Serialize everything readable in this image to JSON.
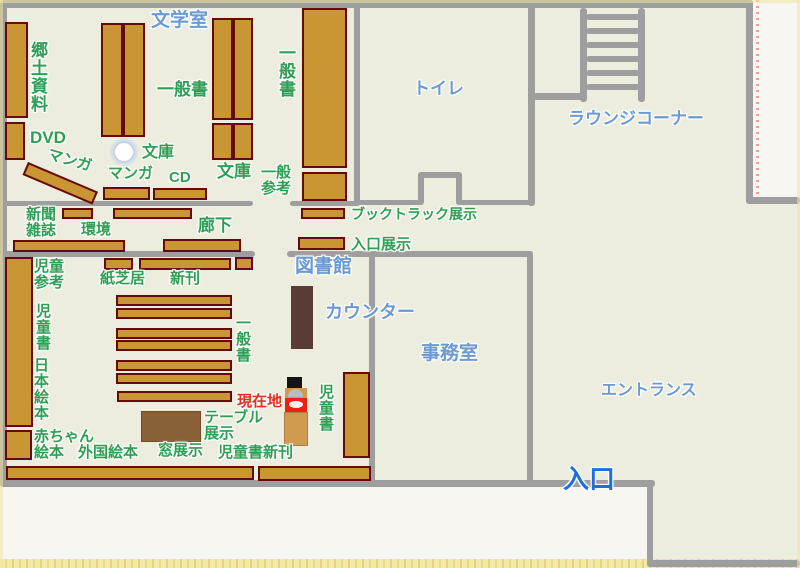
{
  "map_title": "library-floor-map",
  "colors": {
    "paper": "#f7f6f1",
    "room": "#ecedde",
    "wall": "#9e9e9e",
    "shelf": "#ca9634",
    "shelf_border": "#650a0a",
    "counter": "#5a3b36",
    "table": "#8a6137",
    "marker_tan": "#cf9b51",
    "marker_red": "#ee2012",
    "label_green": "#2f9e55",
    "label_blue": "#6b9ad2",
    "label_blue_bright": "#1d6fe0",
    "label_red": "#e53020"
  },
  "areas": [
    [
      0,
      0,
      753,
      487
    ],
    [
      753,
      197,
      47,
      290
    ],
    [
      647,
      487,
      153,
      80
    ]
  ],
  "walls": [
    [
      0,
      0,
      753,
      8
    ],
    [
      0,
      0,
      7,
      487
    ],
    [
      0,
      480,
      655,
      7
    ],
    [
      746,
      0,
      7,
      204
    ],
    [
      746,
      197,
      54,
      7
    ],
    [
      647,
      483,
      6,
      84
    ],
    [
      647,
      560,
      153,
      7
    ],
    [
      354,
      0,
      6,
      205
    ],
    [
      528,
      0,
      7,
      206
    ],
    [
      533,
      93,
      52,
      7
    ],
    [
      0,
      201,
      253,
      5
    ],
    [
      290,
      201,
      70,
      5
    ],
    [
      354,
      200,
      68,
      5
    ],
    [
      456,
      200,
      77,
      5
    ],
    [
      418,
      172,
      6,
      33
    ],
    [
      418,
      172,
      44,
      6
    ],
    [
      456,
      172,
      6,
      33
    ],
    [
      0,
      251,
      255,
      6
    ],
    [
      287,
      251,
      246,
      6
    ],
    [
      369,
      251,
      6,
      232
    ],
    [
      527,
      251,
      6,
      232
    ]
  ],
  "stairs": {
    "rails": [
      [
        580,
        8,
        7,
        94
      ],
      [
        638,
        8,
        7,
        94
      ]
    ],
    "rungs": [
      [
        586,
        14,
        54,
        6
      ],
      [
        586,
        28,
        54,
        6
      ],
      [
        586,
        42,
        54,
        6
      ],
      [
        586,
        56,
        54,
        6
      ],
      [
        586,
        70,
        54,
        6
      ],
      [
        586,
        84,
        54,
        6
      ]
    ]
  },
  "shelves": [
    [
      5,
      22,
      23,
      96
    ],
    [
      5,
      122,
      20,
      38
    ],
    [
      28,
      162,
      76,
      14,
      23
    ],
    [
      101,
      23,
      22,
      114
    ],
    [
      123,
      23,
      22,
      114
    ],
    [
      212,
      18,
      21,
      102
    ],
    [
      233,
      18,
      20,
      102
    ],
    [
      212,
      123,
      21,
      37
    ],
    [
      233,
      123,
      20,
      37
    ],
    [
      302,
      8,
      45,
      160
    ],
    [
      302,
      172,
      45,
      29
    ],
    [
      103,
      187,
      47,
      13
    ],
    [
      153,
      188,
      54,
      12
    ],
    [
      62,
      208,
      31,
      11
    ],
    [
      113,
      208,
      79,
      11
    ],
    [
      13,
      240,
      112,
      12
    ],
    [
      163,
      239,
      78,
      13
    ],
    [
      301,
      208,
      44,
      11
    ],
    [
      298,
      237,
      47,
      13
    ],
    [
      104,
      258,
      29,
      12
    ],
    [
      139,
      258,
      92,
      12
    ],
    [
      235,
      257,
      18,
      13
    ],
    [
      5,
      257,
      28,
      170
    ],
    [
      5,
      430,
      27,
      30
    ],
    [
      116,
      295,
      116,
      11
    ],
    [
      116,
      308,
      116,
      11
    ],
    [
      116,
      328,
      116,
      11
    ],
    [
      116,
      340,
      116,
      11
    ],
    [
      116,
      360,
      116,
      11
    ],
    [
      116,
      373,
      116,
      11
    ],
    [
      117,
      391,
      115,
      11
    ],
    [
      343,
      372,
      27,
      86
    ],
    [
      6,
      466,
      248,
      14
    ],
    [
      258,
      466,
      113,
      15
    ]
  ],
  "objects": {
    "counter": [
      291,
      286,
      22,
      63
    ],
    "table": [
      141,
      411,
      60,
      31
    ],
    "pillar": [
      113,
      141,
      22,
      22
    ]
  },
  "marker": [
    {
      "n": "current-location-cap",
      "c": "mk-cap",
      "r": [
        287,
        377,
        15,
        11
      ]
    },
    {
      "n": "current-location-head",
      "c": "mk-head",
      "r": [
        285,
        388,
        22,
        10
      ]
    },
    {
      "n": "current-location-badge",
      "c": "mk-badge",
      "r": [
        285,
        398,
        22,
        14
      ]
    },
    {
      "n": "current-location-base",
      "c": "mk-base",
      "r": [
        284,
        412,
        24,
        34
      ]
    }
  ],
  "labels": [
    {
      "n": "literature-room-label",
      "t": "文学室",
      "x": 151,
      "y": 11,
      "s": 19,
      "c": "blue"
    },
    {
      "n": "toilet-label",
      "t": "トイレ",
      "x": 413,
      "y": 80,
      "s": 17,
      "c": "blue"
    },
    {
      "n": "lounge-corner-label",
      "t": "ラウンジコーナー",
      "x": 568,
      "y": 110,
      "s": 17,
      "c": "blue"
    },
    {
      "n": "library-label",
      "t": "図書館",
      "x": 295,
      "y": 257,
      "s": 19,
      "c": "blue"
    },
    {
      "n": "counter-label",
      "t": "カウンター",
      "x": 325,
      "y": 303,
      "s": 18,
      "c": "blue"
    },
    {
      "n": "office-label",
      "t": "事務室",
      "x": 421,
      "y": 344,
      "s": 19,
      "c": "blue"
    },
    {
      "n": "entrance-hall-label",
      "t": "エントランス",
      "x": 601,
      "y": 382,
      "s": 16,
      "c": "blue"
    },
    {
      "n": "entrance-door-label",
      "t": "入口",
      "x": 563,
      "y": 465,
      "s": 26,
      "c": "bright"
    },
    {
      "n": "local-materials-label",
      "t": "郷土資料",
      "x": 29,
      "y": 41,
      "s": 17,
      "c": "green",
      "v": true
    },
    {
      "n": "dvd-label",
      "t": "DVD",
      "x": 30,
      "y": 129,
      "s": 17,
      "c": "green"
    },
    {
      "n": "manga-label-1",
      "t": "マンガ",
      "x": 47,
      "y": 153,
      "s": 15,
      "c": "green",
      "r": 16
    },
    {
      "n": "manga-label-2",
      "t": "マンガ",
      "x": 108,
      "y": 166,
      "s": 15,
      "c": "green"
    },
    {
      "n": "cd-label",
      "t": "CD",
      "x": 169,
      "y": 170,
      "s": 15,
      "c": "green"
    },
    {
      "n": "bunko-label-1",
      "t": "文庫",
      "x": 142,
      "y": 144,
      "s": 16,
      "c": "green"
    },
    {
      "n": "bunko-label-2",
      "t": "文庫",
      "x": 217,
      "y": 163,
      "s": 17,
      "c": "green"
    },
    {
      "n": "general-books-label-1",
      "t": "一般書",
      "x": 157,
      "y": 81,
      "s": 17,
      "c": "green"
    },
    {
      "n": "general-books-label-2",
      "t": "一般書",
      "x": 277,
      "y": 44,
      "s": 17,
      "c": "green",
      "v": true
    },
    {
      "n": "general-reference-label",
      "t": "一般\n参考",
      "x": 261,
      "y": 165,
      "s": 15,
      "c": "green"
    },
    {
      "n": "newspapers-magazines-label",
      "t": "新聞\n雑誌",
      "x": 26,
      "y": 207,
      "s": 15,
      "c": "green"
    },
    {
      "n": "environment-label",
      "t": "環境",
      "x": 81,
      "y": 222,
      "s": 15,
      "c": "green"
    },
    {
      "n": "corridor-label",
      "t": "廊下",
      "x": 198,
      "y": 217,
      "s": 17,
      "c": "green"
    },
    {
      "n": "booktruck-display-label",
      "t": "ブックトラック展示",
      "x": 351,
      "y": 207,
      "s": 14,
      "c": "green"
    },
    {
      "n": "entrance-display-label",
      "t": "入口展示",
      "x": 351,
      "y": 237,
      "s": 15,
      "c": "green"
    },
    {
      "n": "kamishibai-label",
      "t": "紙芝居",
      "x": 100,
      "y": 271,
      "s": 15,
      "c": "green"
    },
    {
      "n": "new-books-label",
      "t": "新刊",
      "x": 170,
      "y": 271,
      "s": 15,
      "c": "green"
    },
    {
      "n": "children-reference-label",
      "t": "児童\n参考",
      "x": 34,
      "y": 259,
      "s": 15,
      "c": "green"
    },
    {
      "n": "children-books-label-1",
      "t": "児童書",
      "x": 35,
      "y": 303,
      "s": 15,
      "c": "green",
      "v": true
    },
    {
      "n": "japanese-picture-books-label",
      "t": "日本絵本",
      "x": 33,
      "y": 357,
      "s": 15,
      "c": "green",
      "v": true
    },
    {
      "n": "baby-picture-books-label",
      "t": "赤ちゃん\n絵本",
      "x": 34,
      "y": 429,
      "s": 15,
      "c": "green"
    },
    {
      "n": "foreign-picture-books-label",
      "t": "外国絵本",
      "x": 78,
      "y": 445,
      "s": 15,
      "c": "green"
    },
    {
      "n": "window-display-label",
      "t": "窓展示",
      "x": 158,
      "y": 443,
      "s": 15,
      "c": "green"
    },
    {
      "n": "children-new-books-label",
      "t": "児童書新刊",
      "x": 218,
      "y": 445,
      "s": 15,
      "c": "green"
    },
    {
      "n": "table-display-label",
      "t": "テーブル\n展示",
      "x": 204,
      "y": 410,
      "s": 15,
      "c": "green"
    },
    {
      "n": "general-books-label-3",
      "t": "一般書",
      "x": 235,
      "y": 315,
      "s": 15,
      "c": "green",
      "v": true
    },
    {
      "n": "children-books-label-2",
      "t": "児童書",
      "x": 318,
      "y": 384,
      "s": 15,
      "c": "green",
      "v": true
    },
    {
      "n": "current-location-label",
      "t": "現在地",
      "x": 237,
      "y": 394,
      "s": 15,
      "c": "red"
    }
  ]
}
